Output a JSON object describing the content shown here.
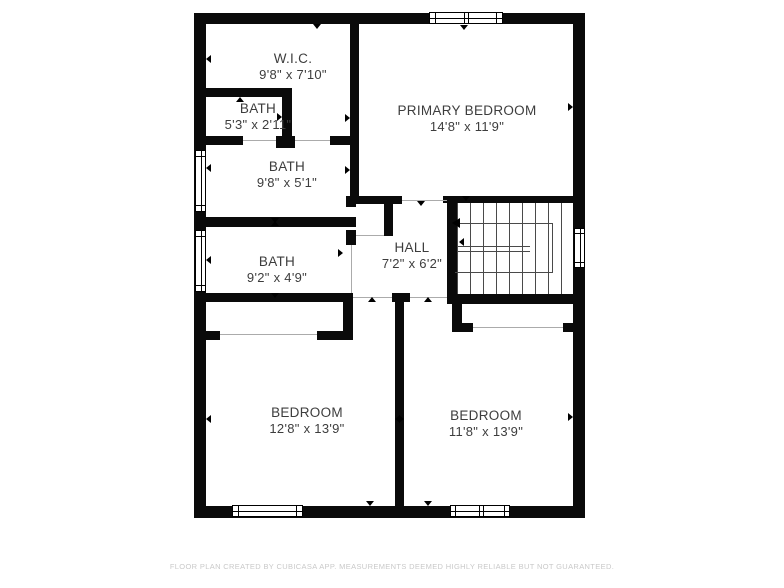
{
  "colors": {
    "wall": "#0a0a0a",
    "room_text": "#3d3d3d",
    "footer_text": "#c9c9c9",
    "stair_line": "#4a4a4a",
    "opening_line": "#ababab"
  },
  "rooms": {
    "wic": {
      "name": "W.I.C.",
      "dims": "9'8\" x 7'10\""
    },
    "bath_small": {
      "name": "BATH",
      "dims": "5'3\" x 2'11\""
    },
    "bath_upper": {
      "name": "BATH",
      "dims": "9'8\" x 5'1\""
    },
    "primary_bedroom": {
      "name": "PRIMARY BEDROOM",
      "dims": "14'8\" x 11'9\""
    },
    "bath_lower": {
      "name": "BATH",
      "dims": "9'2\" x 4'9\""
    },
    "hall": {
      "name": "HALL",
      "dims": "7'2\" x 6'2\""
    },
    "bedroom_left": {
      "name": "BEDROOM",
      "dims": "12'8\" x 13'9\""
    },
    "bedroom_right": {
      "name": "BEDROOM",
      "dims": "11'8\" x 13'9\""
    }
  },
  "footer": {
    "disclaimer": "FLOOR PLAN CREATED BY CUBICASA APP. MEASUREMENTS DEEMED HIGHLY RELIABLE BUT NOT GUARANTEED."
  }
}
